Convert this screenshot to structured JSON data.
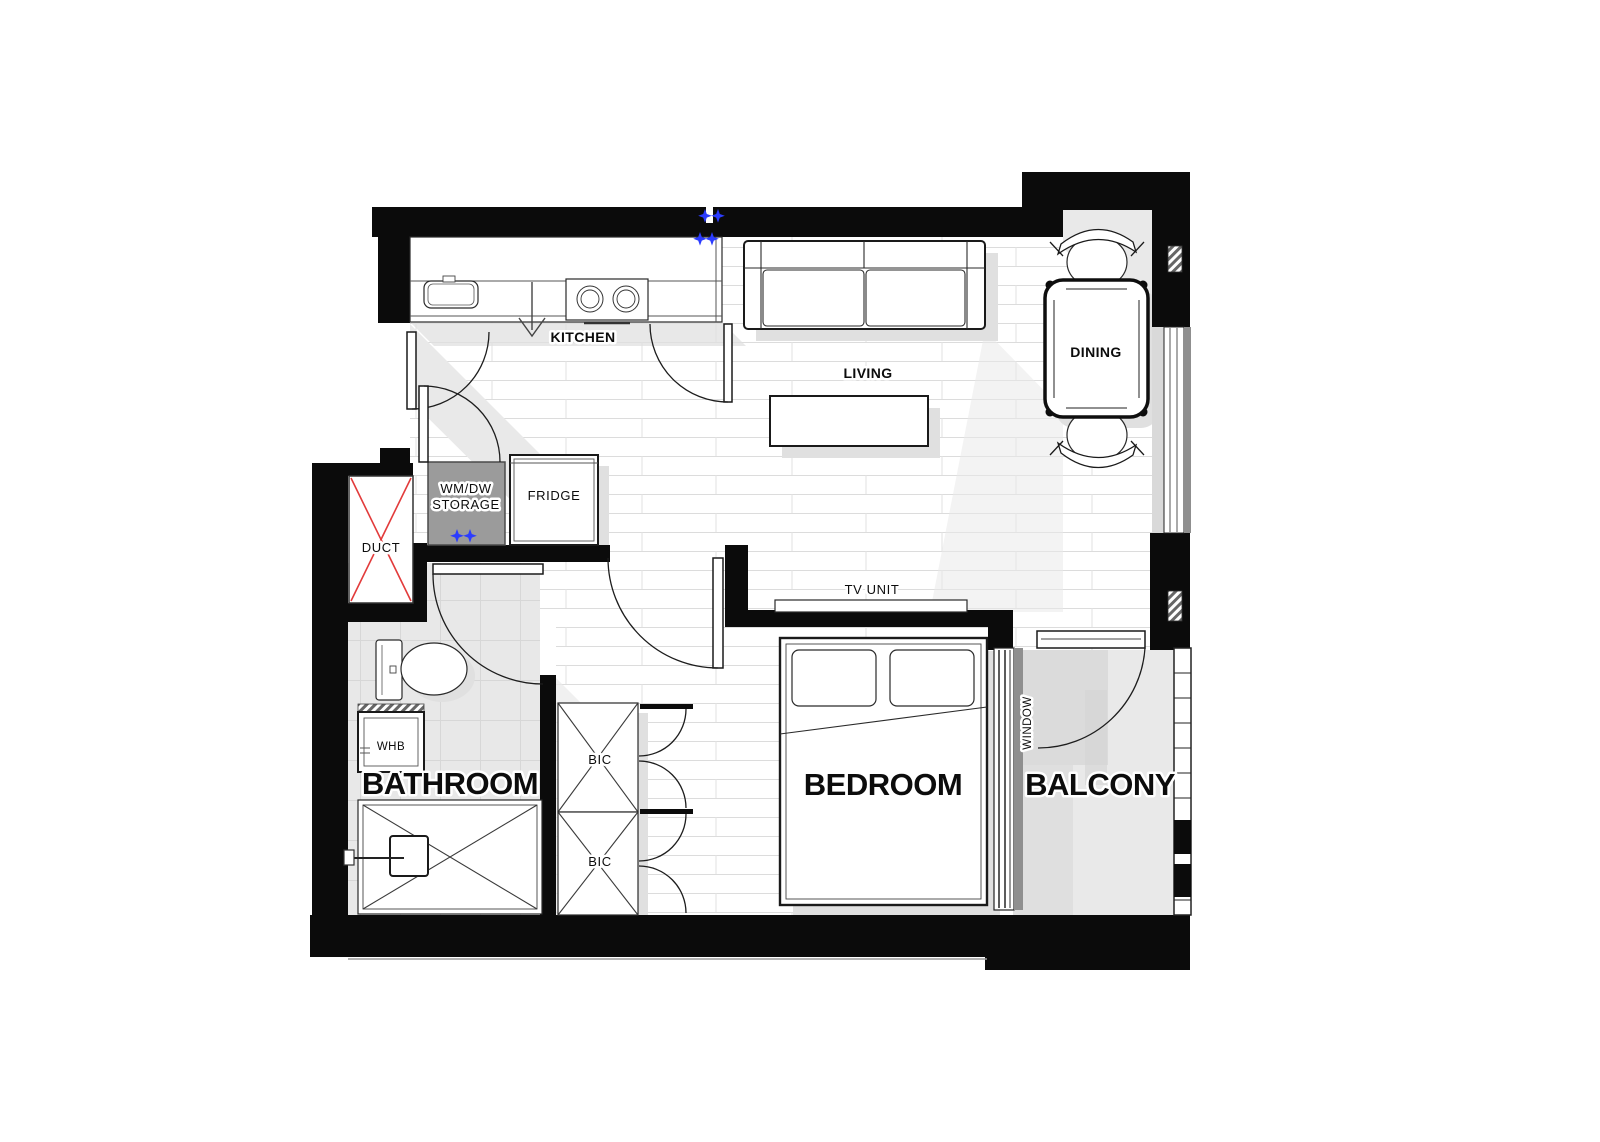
{
  "document": {
    "type": "apartment-floor-plan",
    "background": "#ffffff",
    "width_px": 1600,
    "height_px": 1142
  },
  "labels": {
    "kitchen": "KITCHEN",
    "living": "LIVING",
    "dining": "DINING",
    "duct": "DUCT",
    "wm_dw_line1": "WM/DW",
    "wm_dw_line2": "STORAGE",
    "fridge": "FRIDGE",
    "bathroom": "BATHROOM",
    "whb": "WHB",
    "bic_top": "BIC",
    "bic_bottom": "BIC",
    "tv_unit": "TV UNIT",
    "bedroom": "BEDROOM",
    "balcony": "BALCONY",
    "window": "WINDOW"
  },
  "colors": {
    "walls": "#0b0b0b",
    "duct_cross": "#e23b3b",
    "marker_blue": "#2b3cff",
    "floor_joint": "#dcdcdc",
    "shadow": "#e0e0e0",
    "balcony_floor": "#e9e9e9",
    "exterior_glass": "#8f8f8f"
  },
  "fixtures": [
    "kitchen-counter",
    "sink",
    "hob",
    "entry-direction-arrow",
    "fridge",
    "washer-dishwasher-storage",
    "duct-shaft",
    "toilet",
    "wash-hand-basin",
    "shower",
    "built-in-cupboard-top",
    "built-in-cupboard-bottom",
    "sofa",
    "coffee-table",
    "tv-unit",
    "dining-table",
    "dining-chair-top",
    "dining-chair-bottom",
    "double-bed",
    "pillow-left",
    "pillow-right",
    "balcony-railing",
    "entry-door",
    "storage-door",
    "kitchen-door",
    "bathroom-door",
    "bedroom-door",
    "balcony-door",
    "window-dining",
    "window-bedroom",
    "plumbing-marker-wall",
    "plumbing-marker-storage"
  ]
}
